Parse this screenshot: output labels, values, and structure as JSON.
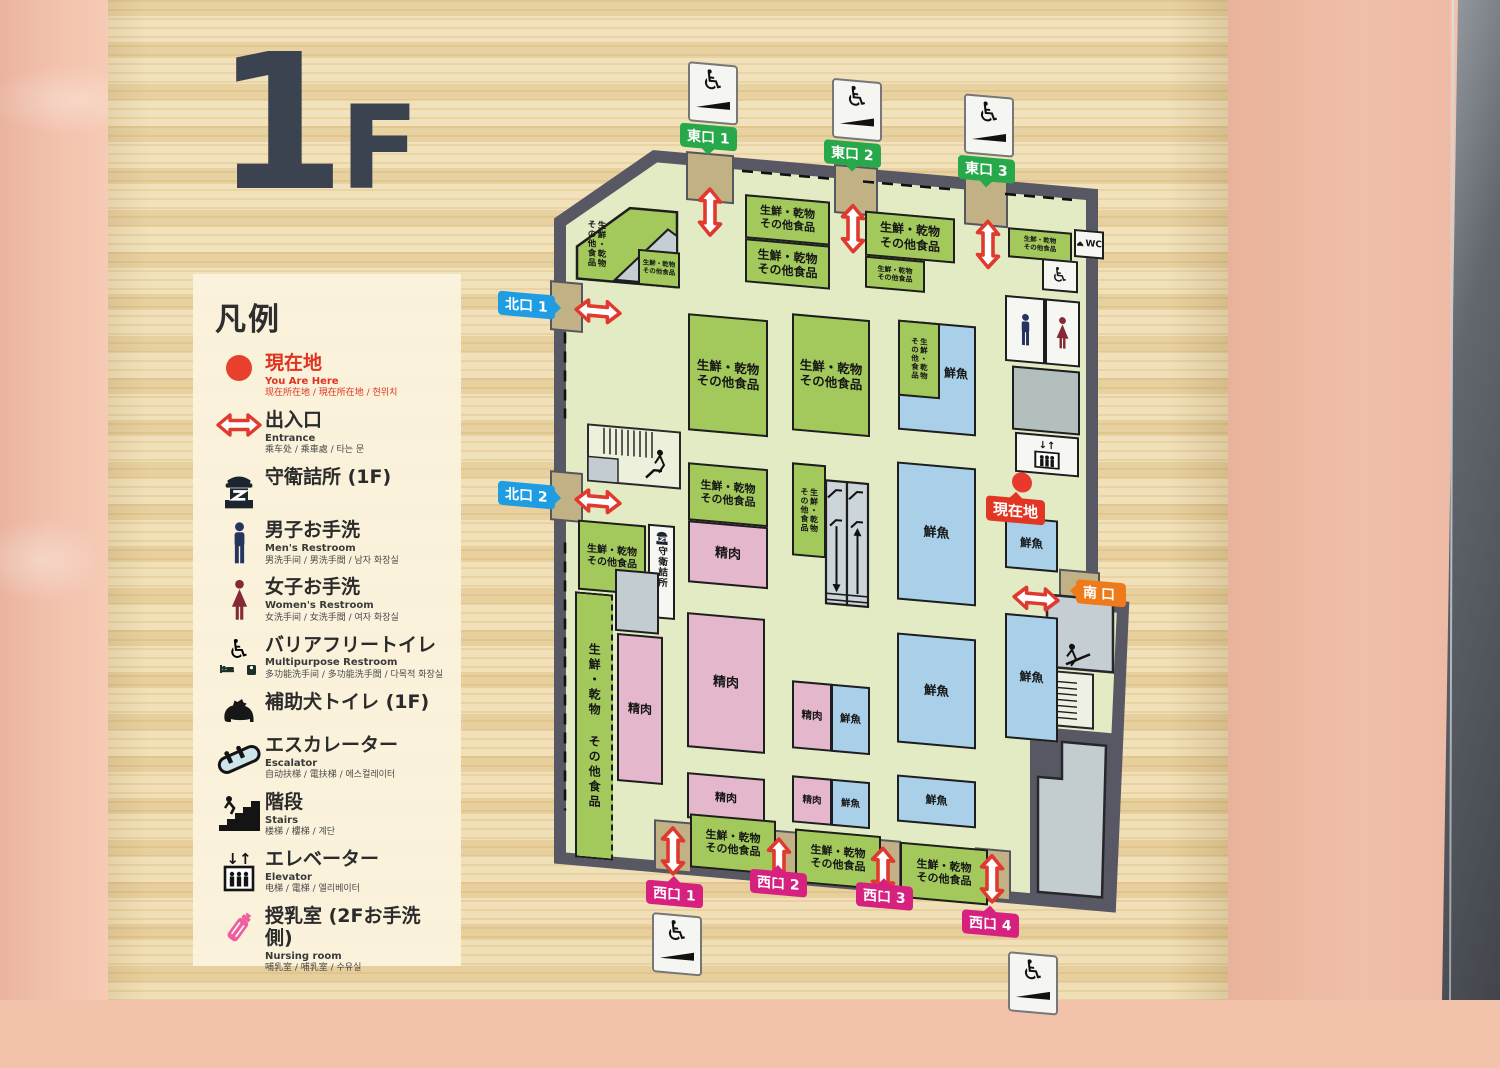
{
  "floor_title": {
    "big": "1",
    "small": "F"
  },
  "legend": {
    "heading": "凡例",
    "items": [
      {
        "label": "現在地",
        "sub_en": "You Are Here",
        "sub_intl": "现在所在地 / 現在所在地 / 현위치"
      },
      {
        "label": "出入口",
        "sub_en": "Entrance",
        "sub_intl": "乘车处 / 乘車處 / 타는 문"
      },
      {
        "label": "守衛詰所 (1F)",
        "sub_en": "",
        "sub_intl": ""
      },
      {
        "label": "男子お手洗",
        "sub_en": "Men's Restroom",
        "sub_intl": "男洗手间 / 男洗手間 / 남자 화장실"
      },
      {
        "label": "女子お手洗",
        "sub_en": "Women's Restroom",
        "sub_intl": "女洗手间 / 女洗手間 / 여자 화장실"
      },
      {
        "label": "バリアフリートイレ",
        "sub_en": "Multipurpose Restroom",
        "sub_intl": "多功能洗手间 / 多功能洗手間 / 다목적 화장실"
      },
      {
        "label": "補助犬トイレ (1F)",
        "sub_en": "",
        "sub_intl": ""
      },
      {
        "label": "エスカレーター",
        "sub_en": "Escalator",
        "sub_intl": "自动扶梯 / 電扶梯 / 에스컬레이터"
      },
      {
        "label": "階段",
        "sub_en": "Stairs",
        "sub_intl": "楼梯 / 樓梯 / 계단"
      },
      {
        "label": "エレベーター",
        "sub_en": "Elevator",
        "sub_intl": "电梯 / 電梯 / 엘리베이터"
      },
      {
        "label": "授乳室 (2Fお手洗側)",
        "sub_en": "Nursing room",
        "sub_intl": "哺乳室 / 哺乳室 / 수유실"
      }
    ]
  },
  "map": {
    "tags": {
      "east": [
        "東口 1",
        "東口 2",
        "東口 3"
      ],
      "north": [
        "北口 1",
        "北口 2"
      ],
      "west": [
        "西口 1",
        "西口 2",
        "西口 3",
        "西口 4"
      ],
      "south": "南口",
      "here": "現在地"
    },
    "zones": {
      "fresh": "生鮮・乾物\nその他食品",
      "fresh_one": "生鮮・乾物 その他食品",
      "meat": "精肉",
      "fish": "鮮魚",
      "guard": "守衛詰所",
      "wc": "WC",
      "elevator_arrows": "↓↑"
    },
    "colors": {
      "zone_fresh": "#a3c95c",
      "zone_meat": "#e5b7cc",
      "zone_fish": "#a9d0e8",
      "wall": "#575863",
      "floor": "#e3ebc4",
      "entrance_pad": "#c1b184",
      "tag_east": "#27a84a",
      "tag_north": "#1e9de3",
      "tag_west": "#d6217f",
      "tag_south": "#ef7a1a",
      "tag_here": "#e33524",
      "arrow_red": "#e0392e"
    }
  }
}
